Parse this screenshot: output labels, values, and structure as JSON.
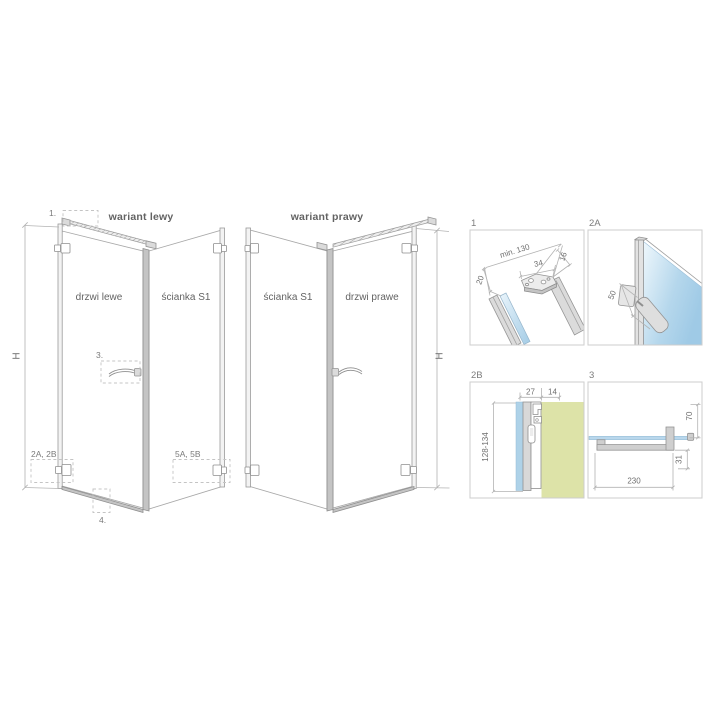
{
  "drawing": {
    "background": "#ffffff"
  },
  "variant_left": {
    "title": "wariant lewy",
    "door_label": "drzwi lewe",
    "wall_label": "ścianka S1",
    "height_dim": "H",
    "callouts": {
      "c1": "1.",
      "c3": "3.",
      "c2ab": "2A, 2B",
      "c5ab": "5A, 5B",
      "c4": "4."
    }
  },
  "variant_right": {
    "title": "wariant prawy",
    "wall_label": "ścianka S1",
    "door_label": "drzwi prawe",
    "height_dim": "H"
  },
  "details": {
    "p1": {
      "label": "1",
      "dims": {
        "span": "min. 130",
        "bracket": "34",
        "bar": "16",
        "offset": "20"
      }
    },
    "p2a": {
      "label": "2A",
      "dims": {
        "hinge": "50"
      }
    },
    "p2b": {
      "label": "2B",
      "dims": {
        "profile": "27",
        "gap": "14",
        "range": "128-134"
      }
    },
    "p3": {
      "label": "3",
      "dims": {
        "length": "230",
        "height": "70",
        "depth": "31"
      }
    }
  },
  "colors": {
    "line": "#a8a8a8",
    "dim_line": "#b3b3b3",
    "text": "#636363",
    "dim_text": "#6f6f6f",
    "glass_blue_light": "#e9f4fb",
    "glass_blue": "#a4cce6",
    "glass_strip": "#aed2e8",
    "wall_fill": "#dde3a8",
    "metal_light": "#dbdbdb",
    "metal_dark": "#c4c4c4",
    "panel_border": "#cdcdcd",
    "background": "#ffffff"
  }
}
